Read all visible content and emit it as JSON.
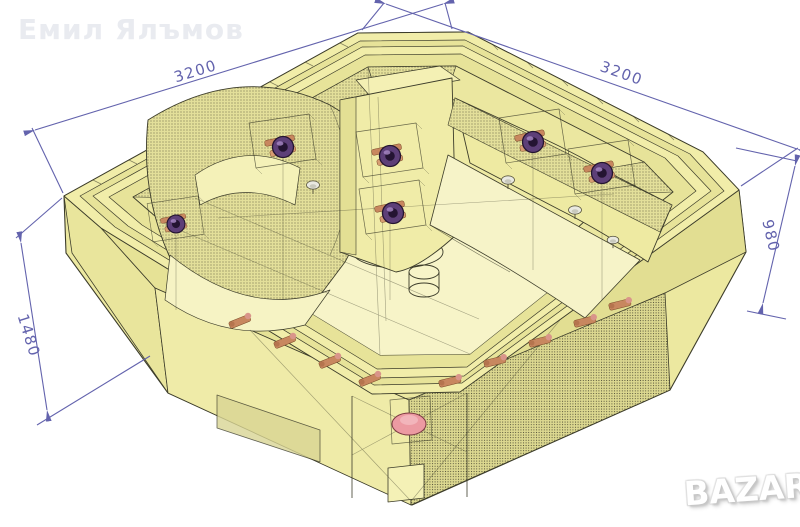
{
  "page": {
    "background": "#ffffff"
  },
  "watermarks": {
    "author_name": "Емил Ялъмов",
    "site_logo_text": "BAZAR"
  },
  "drawing": {
    "subject": "octagonal hot tub CAD wireframe, isometric view",
    "dimensions": {
      "top_left_edge": "3200",
      "top_right_edge": "3200",
      "right_height": "980",
      "left_height": "1480"
    },
    "colors": {
      "body_fill": "#f0eca8",
      "body_fill_light": "#f7f4c8",
      "band_fill": "#e6e298",
      "outline": "#3c3c2a",
      "dimension_lines": "#6363ad",
      "jet": "#5d3f78",
      "fitting": "#c8875f",
      "pump": "#ec9aa2"
    }
  }
}
